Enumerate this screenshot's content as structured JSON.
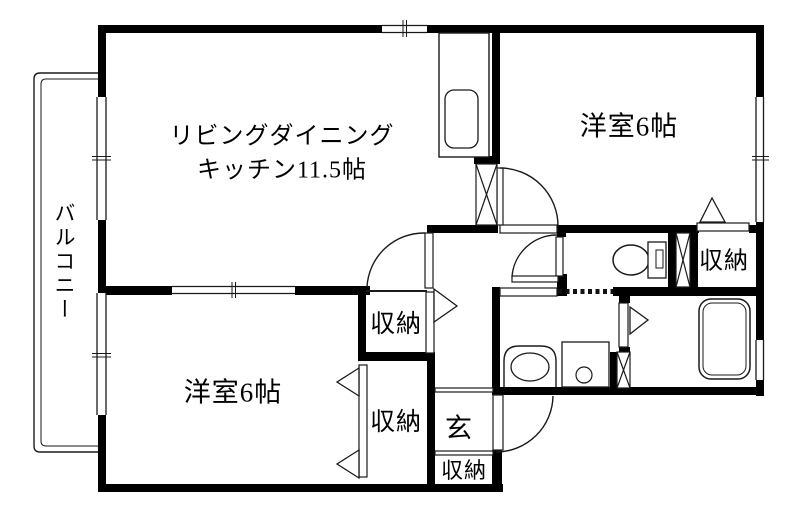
{
  "labels": {
    "balcony": "バルコニー",
    "ldk_line1": "リビングダイニング",
    "ldk_line2": "キッチン11.5帖",
    "bedroom_top_right": "洋室6帖",
    "bedroom_bottom_left": "洋室6帖",
    "closet_hall": "収納",
    "closet_bedroom": "収納",
    "closet_top_right": "収納",
    "closet_entrance": "収納",
    "entrance": "玄"
  },
  "colors": {
    "wall": "#000000",
    "line": "#1a1a1a",
    "background": "#ffffff"
  }
}
